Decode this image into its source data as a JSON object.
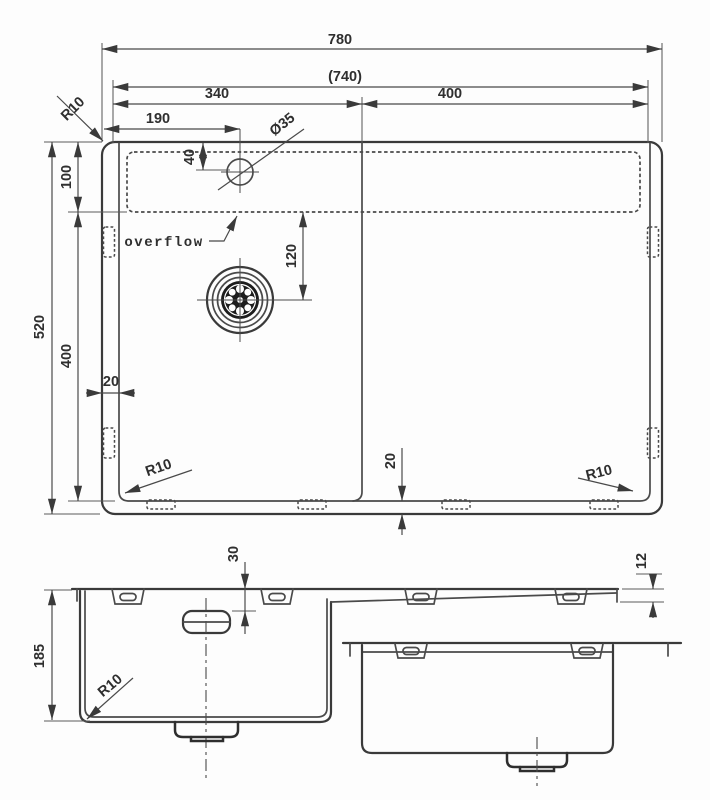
{
  "top_view": {
    "width_overall": "780",
    "width_inner": "(740)",
    "width_left_bowl": "340",
    "width_right_bowl": "400",
    "tap_hole_offset_x": "190",
    "tap_hole_diameter": "Ø35",
    "radius_top_left": "R10",
    "tap_hole_offset_y": "40",
    "rim_depth": "100",
    "depth_overall": "520",
    "bowl_depth": "400",
    "drain_offset": "120",
    "overflow_label": "overflow",
    "wall_gap": "20",
    "base_gap": "20",
    "radius_bottom_left": "R10",
    "radius_bottom_right": "R10"
  },
  "section_view": {
    "boss_offset": "30",
    "rim_thickness": "12",
    "bowl_depth": "185",
    "radius_bottom": "R10"
  }
}
